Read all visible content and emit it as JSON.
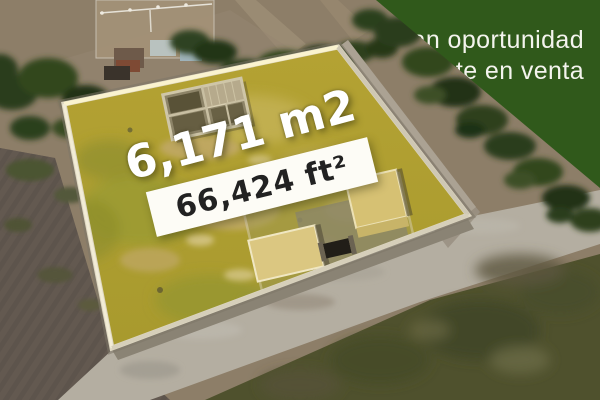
{
  "banner": {
    "line1": "Gran oportunidad",
    "line2": "Lote en venta",
    "background_color": "#30591b",
    "text_color": "#f4f4ee"
  },
  "lot_overlay": {
    "area_m2": "6,171 m2",
    "area_ft2": "66,424 ft²",
    "m2_text_color": "#ffffff",
    "ft2_box_color": "#fdfcf6",
    "ft2_text_color": "#222222"
  },
  "photo": {
    "scene": "aerial-drone-view-of-walled-lot-for-sale",
    "lot_ground_color": "#b2a230",
    "wall_color": "#ded7c2",
    "plowed_field_color": "#665b52",
    "road_color": "#b4aea1",
    "grass_color": "#4f512d",
    "tree_color": "#2b3d1c"
  }
}
